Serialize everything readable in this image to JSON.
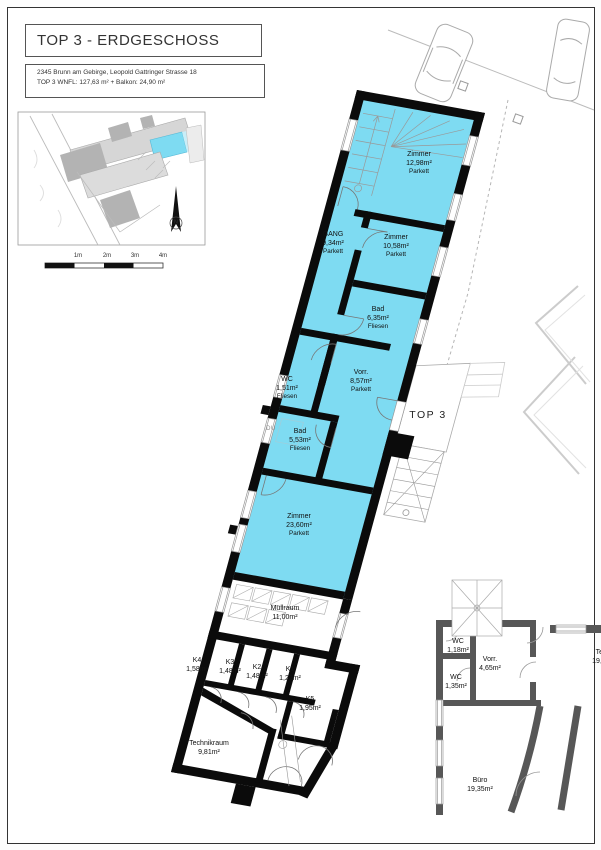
{
  "header": {
    "title": "TOP 3 - ERDGESCHOSS",
    "address": "2345 Brunn am Gebirge, Leopold Gattringer Strasse 18",
    "area_line": "TOP 3 WNFL: 127,63 m² + Balkon: 24,90 m²"
  },
  "plan": {
    "unit_label": "TOP 3",
    "shower_label": "DU",
    "highlight_color": "#7edbf2",
    "wall_color": "#0b0b0b",
    "adjacent_wall_color": "#575757",
    "rooms": [
      {
        "name": "Zimmer",
        "area": "12,98m²",
        "floor": "Parkett",
        "highlighted": true
      },
      {
        "name": "GANG",
        "area": "9,34m²",
        "floor": "Parkett",
        "highlighted": true
      },
      {
        "name": "Zimmer",
        "area": "10,58m²",
        "floor": "Parkett",
        "highlighted": true
      },
      {
        "name": "Bad",
        "area": "6,35m²",
        "floor": "Fliesen",
        "highlighted": true
      },
      {
        "name": "WC",
        "area": "1,51m²",
        "floor": "Fliesen",
        "highlighted": true
      },
      {
        "name": "Vorr.",
        "area": "8,57m²",
        "floor": "Parkett",
        "highlighted": true
      },
      {
        "name": "Bad",
        "area": "5,53m²",
        "floor": "Fliesen",
        "highlighted": true
      },
      {
        "name": "Zimmer",
        "area": "23,60m²",
        "floor": "Parkett",
        "highlighted": true
      },
      {
        "name": "Müllraum",
        "area": "11,00m²",
        "highlighted": false
      },
      {
        "name": "K4",
        "area": "1,58m²",
        "highlighted": false
      },
      {
        "name": "K3",
        "area": "1,48m²",
        "highlighted": false
      },
      {
        "name": "K2",
        "area": "1,48m²",
        "highlighted": false
      },
      {
        "name": "K1",
        "area": "1,22m²",
        "highlighted": false
      },
      {
        "name": "K5",
        "area": "1,95m²",
        "highlighted": false
      },
      {
        "name": "Technikraum",
        "area": "9,81m²",
        "highlighted": false
      },
      {
        "name": "WC",
        "area": "1,18m²",
        "highlighted": false
      },
      {
        "name": "Vorr.",
        "area": "4,65m²",
        "highlighted": false
      },
      {
        "name": "WC",
        "area": "1,35m²",
        "highlighted": false
      },
      {
        "name": "Teekü",
        "area": "19,50m²",
        "highlighted": false
      },
      {
        "name": "Büro",
        "area": "19,35m²",
        "highlighted": false
      }
    ]
  },
  "site_inset": {
    "north_label": "N"
  },
  "scale_bar": {
    "labels": [
      "1m",
      "2m",
      "3m",
      "4m"
    ]
  }
}
